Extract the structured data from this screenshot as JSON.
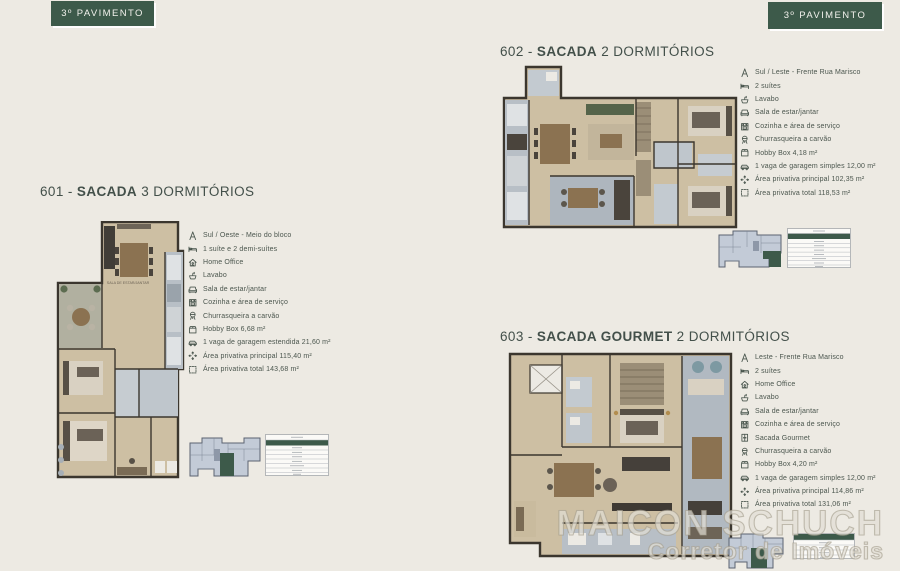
{
  "page": {
    "background_color": "#edeae3",
    "accent_color": "#3d5a4a",
    "banner_left": "3º PAVIMENTO",
    "banner_right": "3º PAVIMENTO"
  },
  "watermark": {
    "line1": "MAICON SCHUCH",
    "line2": "Corretor de Imóveis"
  },
  "units": [
    {
      "id": "601",
      "title_prefix": "601 - ",
      "title_bold": "SACADA",
      "title_suffix": " 3 DORMITÓRIOS",
      "floorplan_label": "SALA DE ESTAR/JANTAR",
      "features": [
        {
          "icon": "compass",
          "text": "Sul / Oeste - Meio do bloco"
        },
        {
          "icon": "bed",
          "text": "1 suíte e 2 demi-suítes"
        },
        {
          "icon": "home-office",
          "text": "Home Office"
        },
        {
          "icon": "sink",
          "text": "Lavabo"
        },
        {
          "icon": "sofa",
          "text": "Sala de estar/jantar"
        },
        {
          "icon": "kitchen",
          "text": "Cozinha e área de serviço"
        },
        {
          "icon": "grill",
          "text": "Churrasqueira a carvão"
        },
        {
          "icon": "box",
          "text": "Hobby Box 6,68 m²"
        },
        {
          "icon": "car",
          "text": "1 vaga de garagem estendida 21,60 m²"
        },
        {
          "icon": "expand",
          "text": "Área privativa principal 115,40 m²"
        },
        {
          "icon": "outline",
          "text": "Área privativa total 143,68 m²"
        }
      ]
    },
    {
      "id": "602",
      "title_prefix": "602 - ",
      "title_bold": "SACADA",
      "title_suffix": " 2 DORMITÓRIOS",
      "features": [
        {
          "icon": "compass",
          "text": "Sul / Leste - Frente Rua Marisco"
        },
        {
          "icon": "bed",
          "text": "2 suítes"
        },
        {
          "icon": "sink",
          "text": "Lavabo"
        },
        {
          "icon": "sofa",
          "text": "Sala de estar/jantar"
        },
        {
          "icon": "kitchen",
          "text": "Cozinha e área de serviço"
        },
        {
          "icon": "grill",
          "text": "Churrasqueira a carvão"
        },
        {
          "icon": "box",
          "text": "Hobby Box 4,18 m²"
        },
        {
          "icon": "car",
          "text": "1 vaga de garagem simples 12,00 m²"
        },
        {
          "icon": "expand",
          "text": "Área privativa principal 102,35 m²"
        },
        {
          "icon": "outline",
          "text": "Área privativa total 118,53 m²"
        }
      ]
    },
    {
      "id": "603",
      "title_prefix": "603 - ",
      "title_bold": "SACADA GOURMET",
      "title_suffix": " 2 DORMITÓRIOS",
      "features": [
        {
          "icon": "compass",
          "text": "Leste - Frente Rua Marisco"
        },
        {
          "icon": "bed",
          "text": "2 suítes"
        },
        {
          "icon": "home-office",
          "text": "Home Office"
        },
        {
          "icon": "sink",
          "text": "Lavabo"
        },
        {
          "icon": "sofa",
          "text": "Sala de estar/jantar"
        },
        {
          "icon": "kitchen",
          "text": "Cozinha e área de serviço"
        },
        {
          "icon": "balcony",
          "text": "Sacada Gourmet"
        },
        {
          "icon": "grill",
          "text": "Churrasqueira a carvão"
        },
        {
          "icon": "box",
          "text": "Hobby Box 4,20 m²"
        },
        {
          "icon": "car",
          "text": "1 vaga de garagem simples 12,00 m²"
        },
        {
          "icon": "expand",
          "text": "Área privativa principal 114,86 m²"
        },
        {
          "icon": "outline",
          "text": "Área privativa total 131,06 m²"
        }
      ]
    }
  ]
}
